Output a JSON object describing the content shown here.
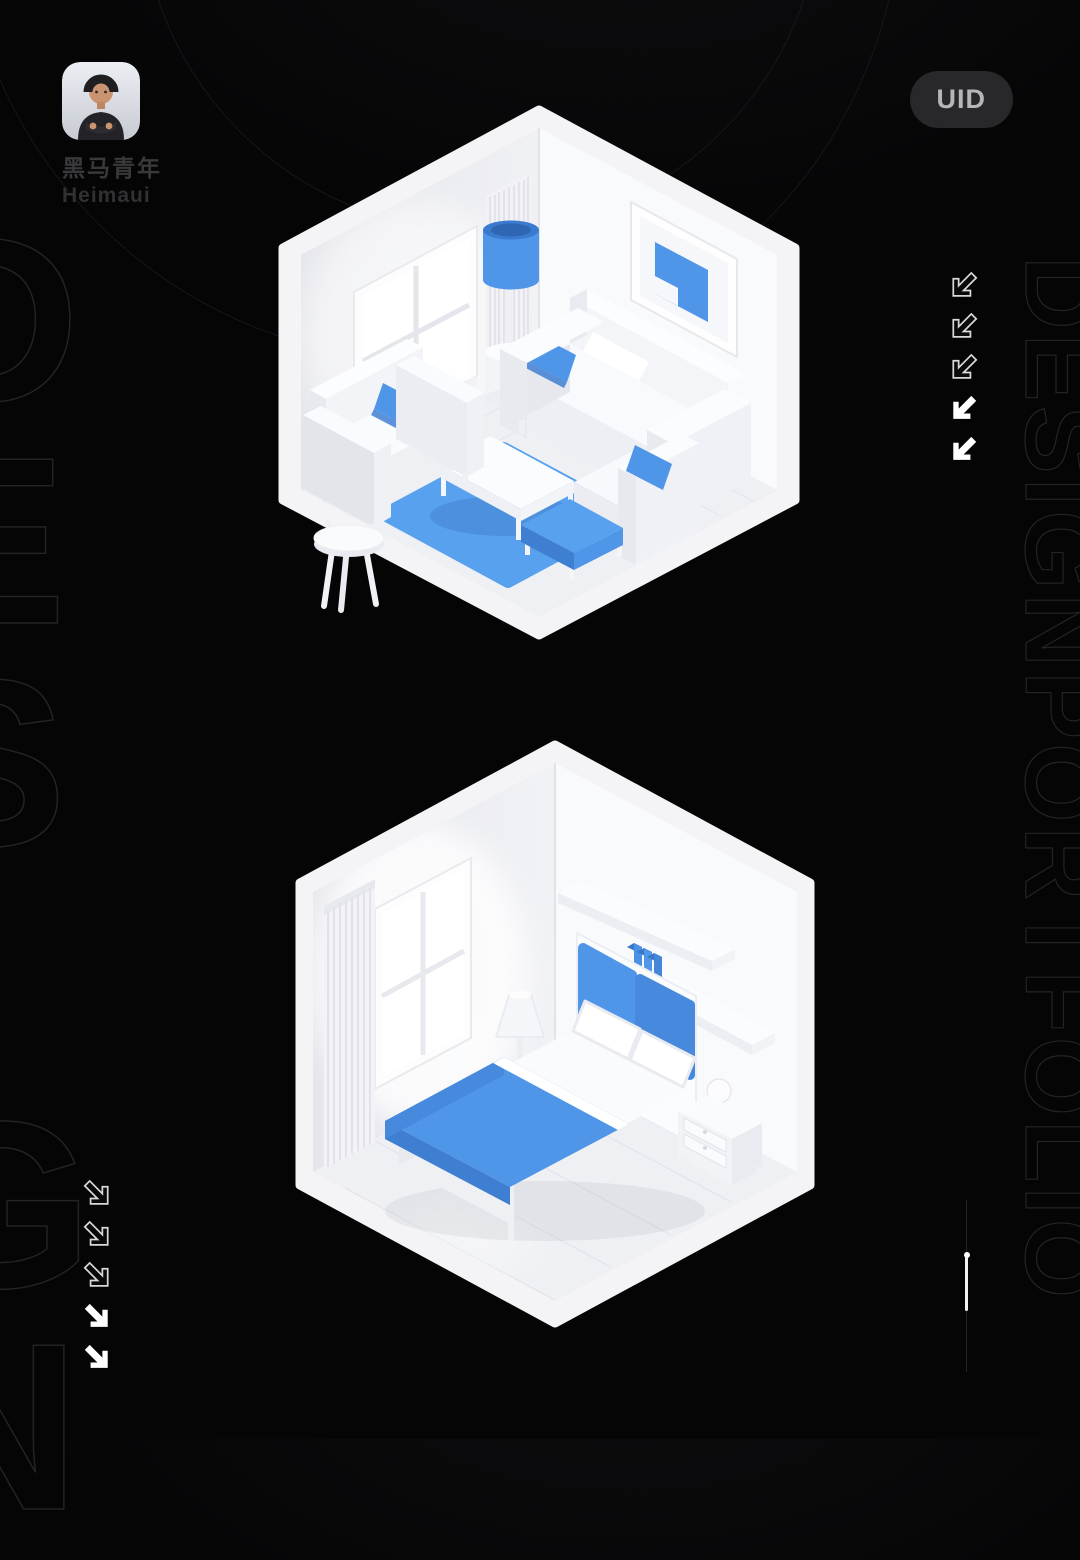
{
  "profile": {
    "name_cn": "黑马青年",
    "name_en": "Heimaui",
    "avatar": "memoji-man-black-tshirt-crossed-arms"
  },
  "badge": {
    "label": "UID"
  },
  "decor": {
    "left_giant_text": "D\nE\nS\nI\nG\nN",
    "right_vertical_text": "DESIGNPORTFOLIO",
    "left_arrows": {
      "direction": "down-right",
      "count": 5,
      "outlined": 3,
      "solid": 2
    },
    "right_arrows": {
      "direction": "down-left",
      "count": 5,
      "outlined": 3,
      "solid": 2
    }
  },
  "scenes": [
    {
      "name": "living-room-isometric-render",
      "style": "white and blue 3D miniature room",
      "objects": [
        "window",
        "fluted-panel",
        "wall-art",
        "floor-lamp",
        "loveseat",
        "sofa",
        "armchair",
        "blue-pillows",
        "coffee-table",
        "blue-rug",
        "blue-ottoman",
        "side-stool"
      ]
    },
    {
      "name": "bedroom-isometric-render",
      "style": "white and blue 3D miniature room",
      "objects": [
        "curtain",
        "window",
        "wall-shelves",
        "blue-books",
        "cone-table-lamp",
        "nightstand",
        "double-bed",
        "blue-headboard",
        "pillows",
        "blue-duvet",
        "drawer-nightstand",
        "sphere-lamp"
      ]
    }
  ],
  "theme": {
    "colors": {
      "accent": "#4f95e8",
      "accent-dark": "#3e7fd2",
      "accent-mid": "#4689dd",
      "accent-light": "#58a1ee",
      "pill-bg": "#28282a",
      "pill-text": "#b6b6b8"
    }
  }
}
